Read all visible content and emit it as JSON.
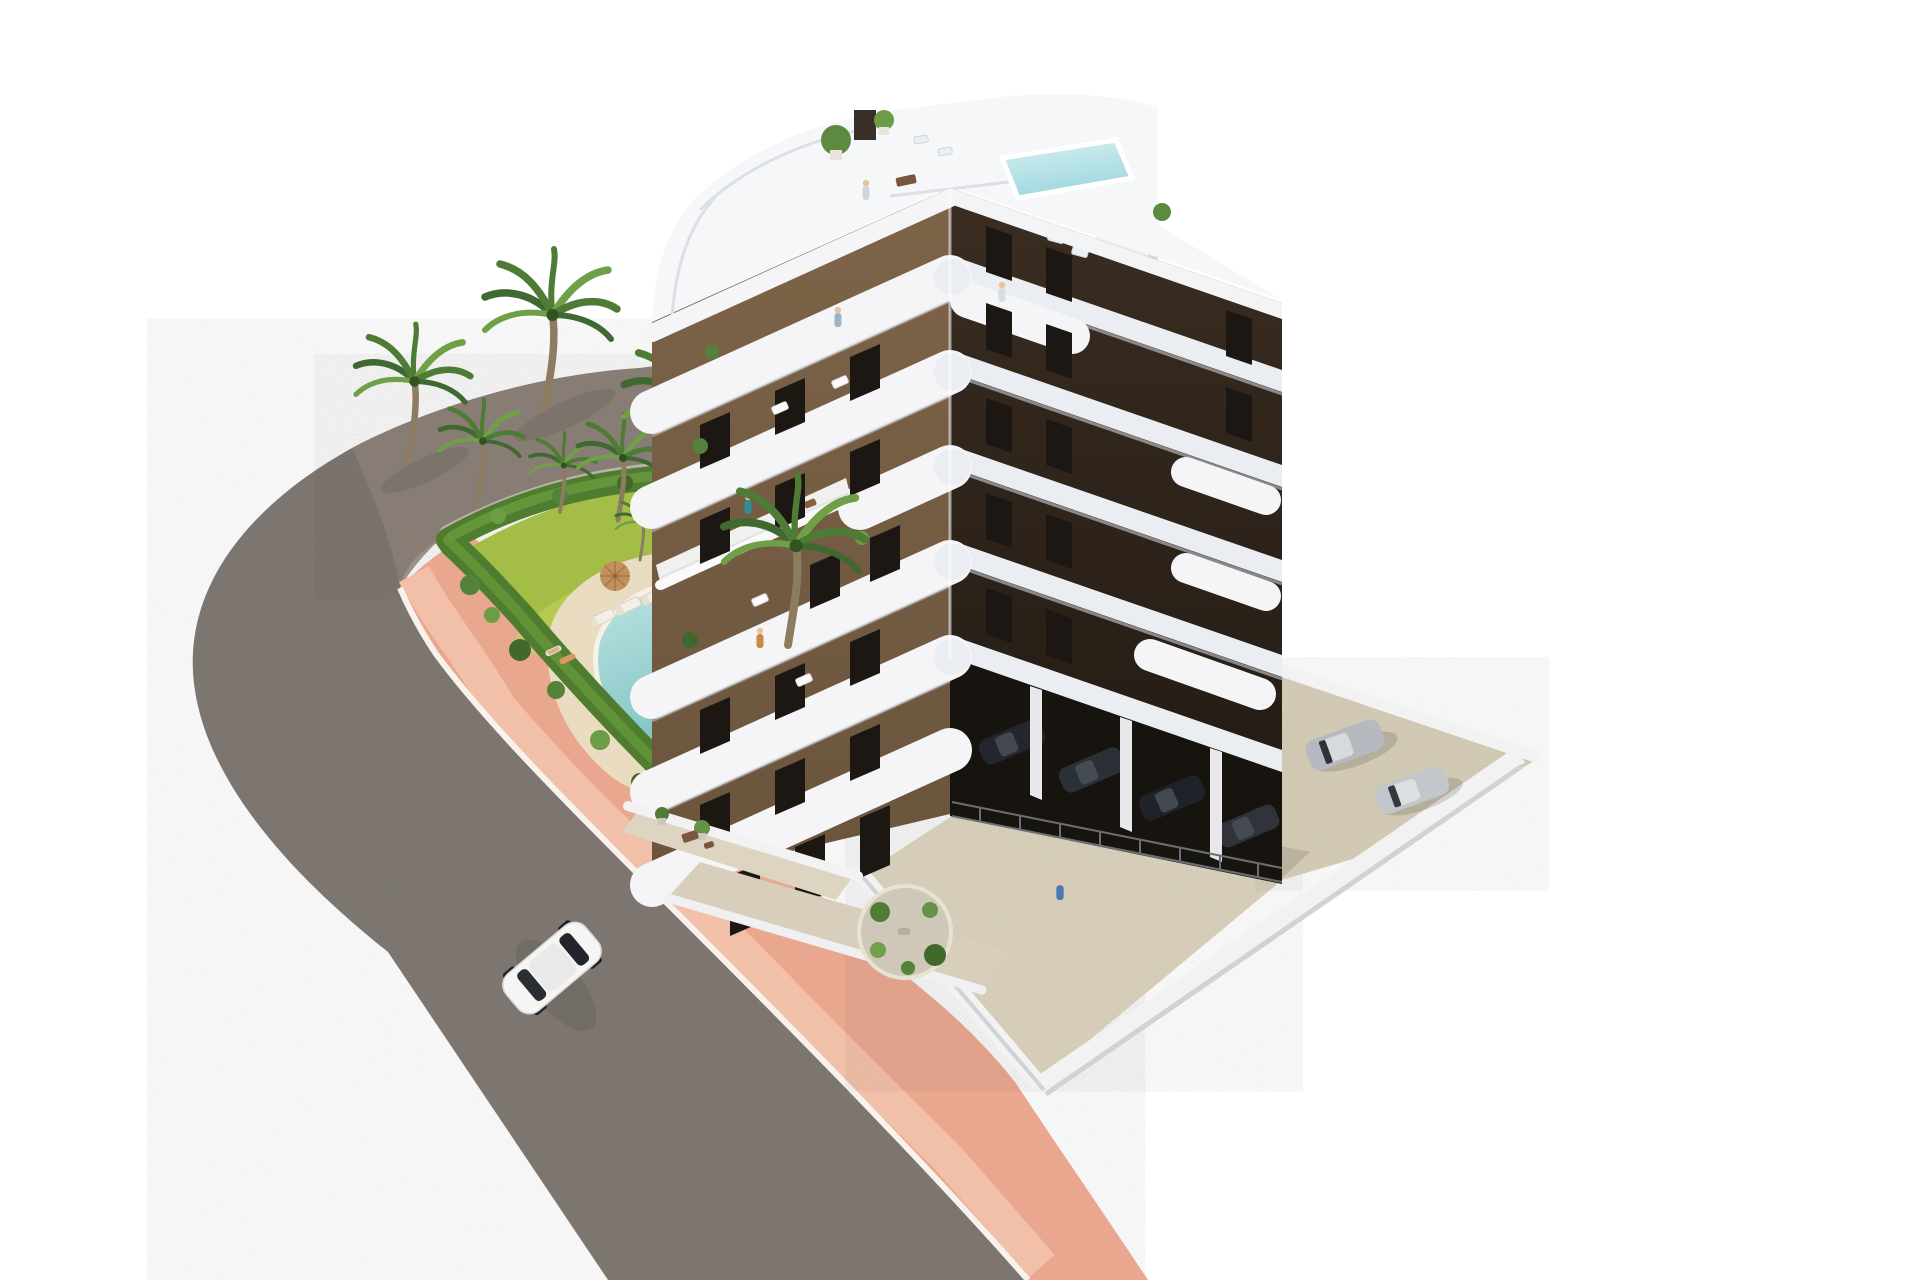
{
  "scene": {
    "label": "aerial-architectural-render-apartment-complex",
    "background": "#ffffff",
    "colors": {
      "road": "#7e7772",
      "gravel": "#8d8178",
      "sidewalk": "#e9a78f",
      "sidewalk_light": "#f2bfa8",
      "curb": "#f7f3ec",
      "hedge": "#4f7c2e",
      "hedge_light": "#699b3d",
      "lawn": "#a4bd46",
      "lawn_light": "#c3d55f",
      "lawn_dark": "#8aa738",
      "pebbles": "#b8b2a7",
      "sand": "#e9dcc0",
      "pool_rim": "#f6f2e6",
      "pool_shallow": "#bfe4e2",
      "pool_deep": "#7fc3c4",
      "rooftop_pool_shallow": "#d6f0f2",
      "rooftop_pool_deep": "#9fd8de",
      "roof_white": "#f6f7f9",
      "core_white": "#eef0f4",
      "band_white": "#eaedf1",
      "pill_white": "#f5f5f7",
      "band_shadow": "#c9ccd2",
      "wall_left": "#7d6449",
      "wall_right": "#3b2d21",
      "window_dark": "#1c1713",
      "parking_floor": "#d8d0bb",
      "parking_dark": "#17140f",
      "wall_white": "#f2f2f3",
      "terrace_floor": "#ddd5c2",
      "patio": "#cfc8b8",
      "car_white": "#f5f5f4",
      "car_silver_1": "#b6bac0",
      "car_silver_2": "#c3c6ca",
      "car_dark": "#23262c",
      "palm_trunk": "#8d7c60",
      "frond_dark": "#3f6930",
      "frond_mid": "#4e7c34",
      "frond_light": "#6fa047",
      "skin": "#e6c49d",
      "umbrella": "#c2905e",
      "person_teal": "#2e8f96",
      "person_blue": "#9fb3c8",
      "person_orange": "#cc8844",
      "shadow": "rgba(60,55,50,0.18)"
    },
    "objects": {
      "building": {
        "label": "apartment-building",
        "floors": 7,
        "style": "white curved balcony bands over brown facades",
        "rooftop": {
          "terrace": true,
          "plunge_pool": true,
          "planters": 3,
          "chimney": 1
        },
        "elevator_core": "tall white slab on right side"
      },
      "garden": {
        "label": "communal-pool-garden",
        "pool_shape": "kidney",
        "sun_loungers": 5,
        "umbrellas": 2,
        "palm_trees": 8,
        "hedge_border": true,
        "pebble_beds": true
      },
      "road": {
        "label": "curved-asphalt-road",
        "sidewalk": "pink with white curb",
        "unpaved_strip": "gravel behind hedge"
      },
      "parking": {
        "label": "parking-court",
        "perimeter": "white walls",
        "covered_bays_under_building": true
      },
      "vehicles": {
        "street_white_car": 1,
        "parked_silver_cars": 2,
        "covered_dark_cars": 4
      },
      "people": 10
    }
  }
}
